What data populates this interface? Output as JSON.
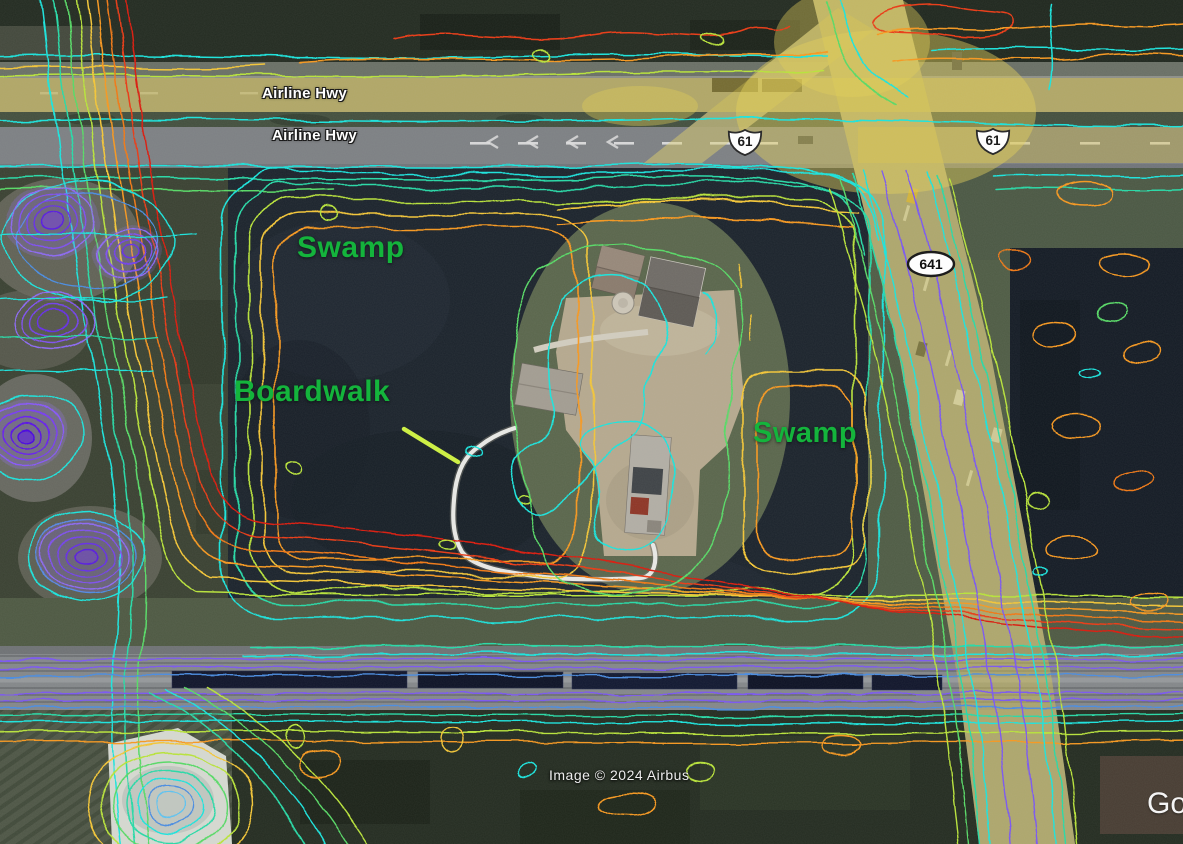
{
  "map": {
    "road_labels": {
      "upper": "Airline Hwy",
      "lower": "Airline Hwy"
    },
    "route_shields": {
      "us61_west": "61",
      "us61_east": "61",
      "la641": "641"
    },
    "place_labels": {
      "swamp_west": "Swamp",
      "boardwalk": "Boardwalk",
      "swamp_east": "Swamp"
    },
    "attribution": "Image © 2024 Airbus",
    "watermark_partial": "Go"
  },
  "style": {
    "place_label_color": "#14b43c",
    "road_label_color": "#ffffff",
    "leader_line_color": "#cdef46",
    "road_glow_color": "#d8bf4e",
    "contour_colors": {
      "cyan": "#22e3dc",
      "teal": "#2ed9a8",
      "green": "#5cd96a",
      "yellow_green": "#b9e23f",
      "yellow": "#f2c63c",
      "orange": "#f59a27",
      "deep_orange": "#ef7c1e",
      "red": "#e8401c",
      "deep_red": "#d92313",
      "purple": "#7e5bef",
      "violet": "#6316f0",
      "blue": "#4f8fe0",
      "light_blue": "#62c3ef"
    }
  }
}
